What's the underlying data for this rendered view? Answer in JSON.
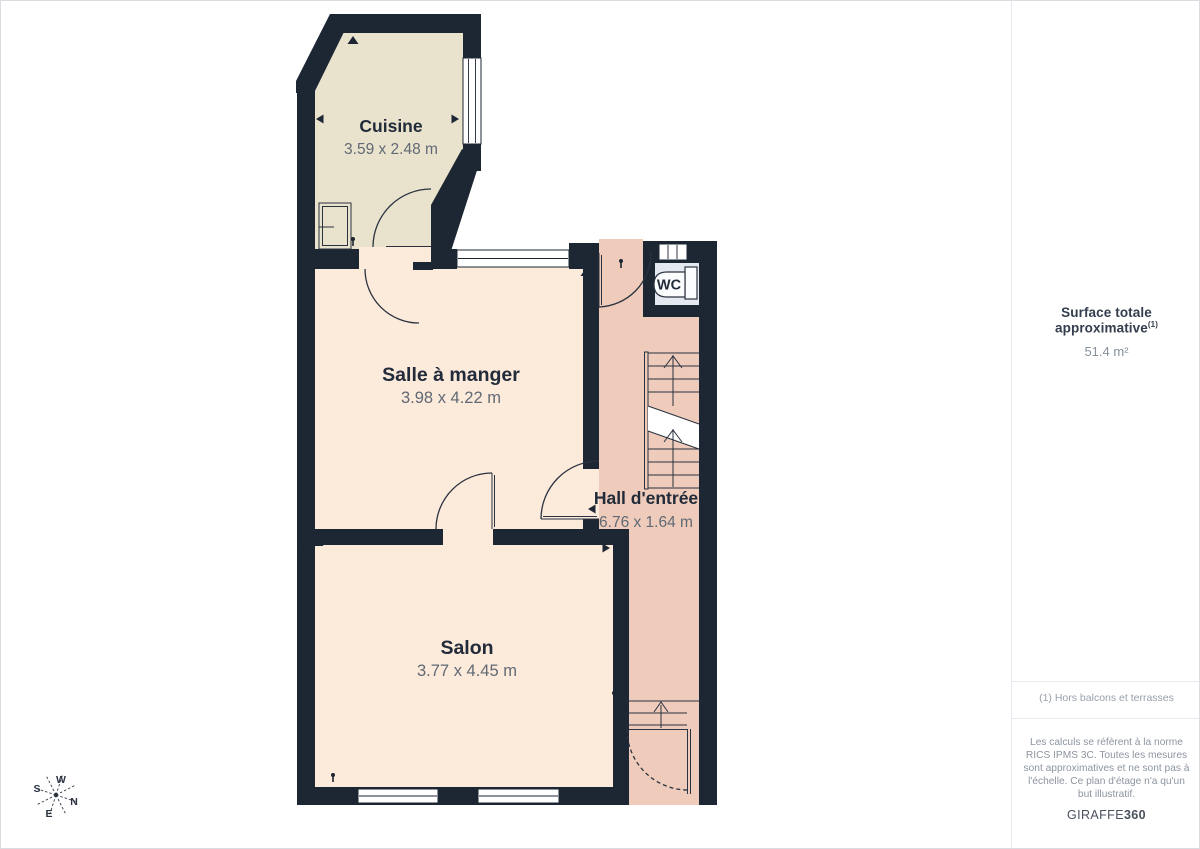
{
  "page": {
    "background": "#ffffff",
    "border_color": "#d9dde2"
  },
  "floor_plan": {
    "wall_color": "#1d2633",
    "label_color": "#222b3a",
    "dimension_color": "#606974",
    "rooms": [
      {
        "id": "cuisine",
        "name": "Cuisine",
        "dimensions": "3.59 x 2.48 m",
        "floor_color": "#e9e3ce"
      },
      {
        "id": "salle-a-manger",
        "name": "Salle à manger",
        "dimensions": "3.98 x 4.22 m",
        "floor_color": "#fceadb"
      },
      {
        "id": "salon",
        "name": "Salon",
        "dimensions": "3.77 x 4.45 m",
        "floor_color": "#fceadb"
      },
      {
        "id": "hall-entree",
        "name": "Hall d'entrée",
        "dimensions": "6.76 x 1.64 m",
        "floor_color": "#eecbba"
      },
      {
        "id": "wc",
        "name": "WC",
        "floor_color": "#e4e8ef"
      }
    ],
    "compass": {
      "n": "N",
      "s": "S",
      "e": "E",
      "w": "W"
    }
  },
  "sidebar": {
    "total_area_label": "Surface totale approximative",
    "total_area_footnote_marker": "(1)",
    "total_area_value": "51.4 m²",
    "footnote": "(1) Hors balcons et terrasses",
    "disclaimer": "Les calculs se réfèrent à la norme RICS IPMS 3C. Toutes les mesures sont approximatives et ne sont pas à l'échelle. Ce plan d'étage n'a qu'un but illustratif.",
    "brand_name": "GIRAFFE",
    "brand_suffix": "360"
  }
}
